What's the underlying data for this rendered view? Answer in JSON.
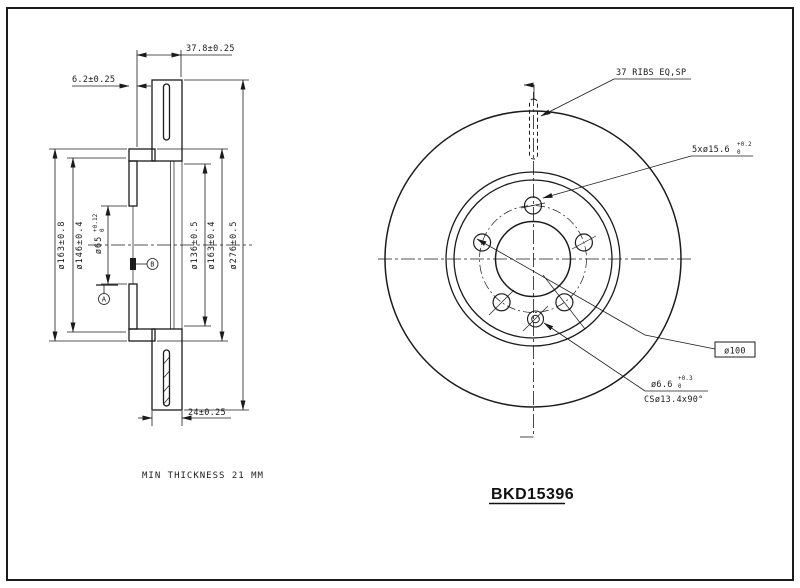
{
  "labels": {
    "part_number": "BKD15396",
    "min_thickness": "MIN THICKNESS 21 MM"
  },
  "section_dims": {
    "total_width": "37.8±0.25",
    "hat_offset": "6.2±0.25",
    "ring_width": "24±0.25",
    "hat_od_left": "ø163±0.8",
    "flange_od": "ø146±0.4",
    "bore": "ø65",
    "bore_tol_plus": "+0.12",
    "bore_tol_base": "0",
    "friction_id": "ø136±0.5",
    "hat_od_right": "ø163±0.4",
    "disc_od": "ø276±0.5",
    "datum_a": "A",
    "datum_b": "B"
  },
  "front_dims": {
    "ribs_note": "37 RIBS EQ,SP",
    "bolt_holes": "5xø15.6",
    "bolt_holes_tol_plus": "+0.2",
    "bolt_holes_tol_base": "0",
    "pcd": "ø100",
    "screw_hole": "ø6.6",
    "screw_tol_plus": "+0.3",
    "screw_tol_base": "0",
    "countersink": "CSø13.4x90°"
  },
  "colors": {
    "ink": "#1b1b1b",
    "paper": "#ffffff"
  }
}
